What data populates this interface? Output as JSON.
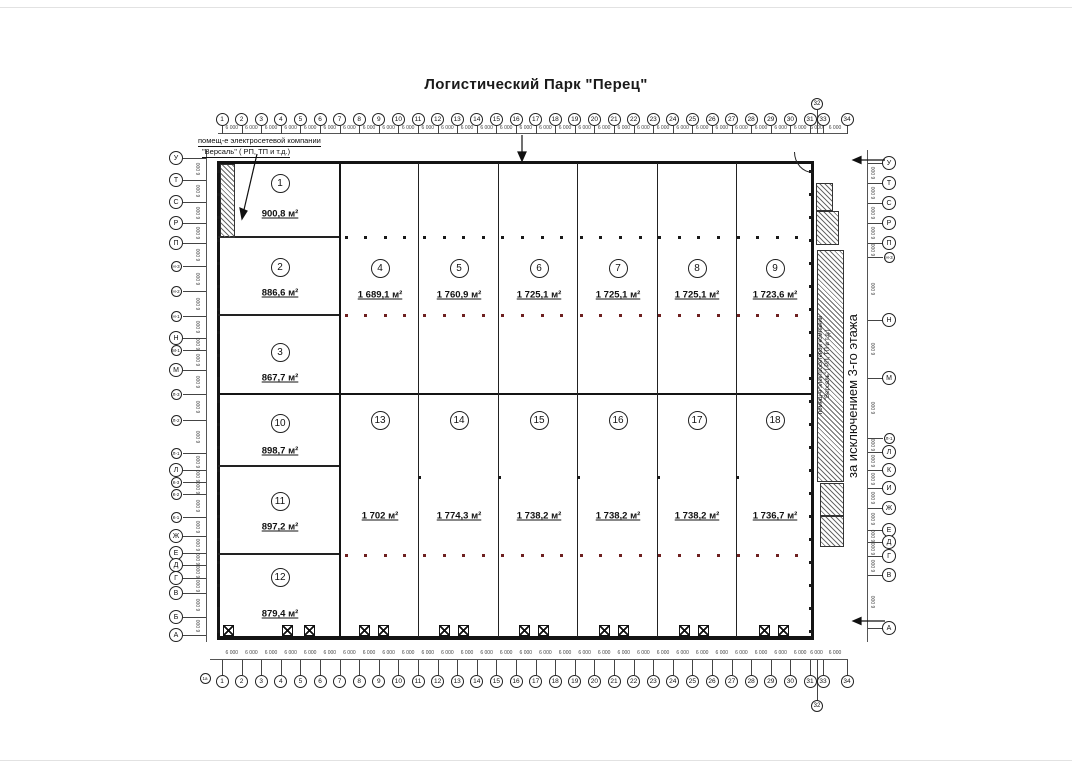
{
  "title": "Логистический Парк \"Перец\"",
  "notes": {
    "electro_top_line1": "помещ-е электросетевой компании",
    "electro_top_line2": "\"Версаль\" ( РП, ТП и т.д.)",
    "electro_right_line1": "помещ-е электросетевой компании",
    "electro_right_line2": "\"Версаль\" ( РП, ТП и т.д.)",
    "exclusion": "за исключением 3-го этажа"
  },
  "axes": {
    "top": [
      "1",
      "2",
      "3",
      "4",
      "5",
      "6",
      "7",
      "8",
      "9",
      "10",
      "11",
      "12",
      "13",
      "14",
      "15",
      "16",
      "17",
      "18",
      "19",
      "20",
      "21",
      "22",
      "23",
      "24",
      "25",
      "26",
      "27",
      "28",
      "29",
      "30",
      "31",
      "33",
      "34"
    ],
    "top_offset": "32",
    "bottom": [
      "1",
      "2",
      "3",
      "4",
      "5",
      "6",
      "7",
      "8",
      "9",
      "10",
      "11",
      "12",
      "13",
      "14",
      "15",
      "16",
      "17",
      "18",
      "19",
      "20",
      "21",
      "22",
      "23",
      "24",
      "25",
      "26",
      "27",
      "28",
      "29",
      "30",
      "31",
      "33",
      "34"
    ],
    "bottom_offset": "32",
    "bottom_extra": "1а",
    "left": [
      "У",
      "Т",
      "С",
      "Р",
      "П",
      "Н-3",
      "Н-2",
      "Н-1",
      "Н",
      "М-1",
      "М",
      "Л-3",
      "Л-2",
      "Л-1",
      "Л",
      "К-3",
      "К-2",
      "К-1",
      "Ж",
      "Е",
      "Д",
      "Г",
      "В",
      "Б",
      "А"
    ],
    "right": [
      "У",
      "Т",
      "С",
      "Р",
      "П",
      "Н-3",
      "Н",
      "М",
      "Л-1",
      "Л",
      "К",
      "И",
      "Ж",
      "Е",
      "Д",
      "Г",
      "В",
      "А"
    ],
    "dim": "6 000"
  },
  "zones": [
    {
      "num": "1",
      "area": "900,8 м²"
    },
    {
      "num": "2",
      "area": "886,6 м²"
    },
    {
      "num": "3",
      "area": "867,7 м²"
    },
    {
      "num": "4",
      "area": "1 689,1 м²"
    },
    {
      "num": "5",
      "area": "1 760,9 м²"
    },
    {
      "num": "6",
      "area": "1 725,1 м²"
    },
    {
      "num": "7",
      "area": "1 725,1 м²"
    },
    {
      "num": "8",
      "area": "1 725,1 м²"
    },
    {
      "num": "9",
      "area": "1 723,6 м²"
    },
    {
      "num": "10",
      "area": "898,7 м²"
    },
    {
      "num": "11",
      "area": "897,2 м²"
    },
    {
      "num": "12",
      "area": "879,4 м²"
    },
    {
      "num": "13",
      "area": "1 702 м²"
    },
    {
      "num": "14",
      "area": "1 774,3 м²"
    },
    {
      "num": "15",
      "area": "1 738,2 м²"
    },
    {
      "num": "16",
      "area": "1 738,2 м²"
    },
    {
      "num": "17",
      "area": "1 738,2 м²"
    },
    {
      "num": "18",
      "area": "1 736,7 м²"
    }
  ]
}
